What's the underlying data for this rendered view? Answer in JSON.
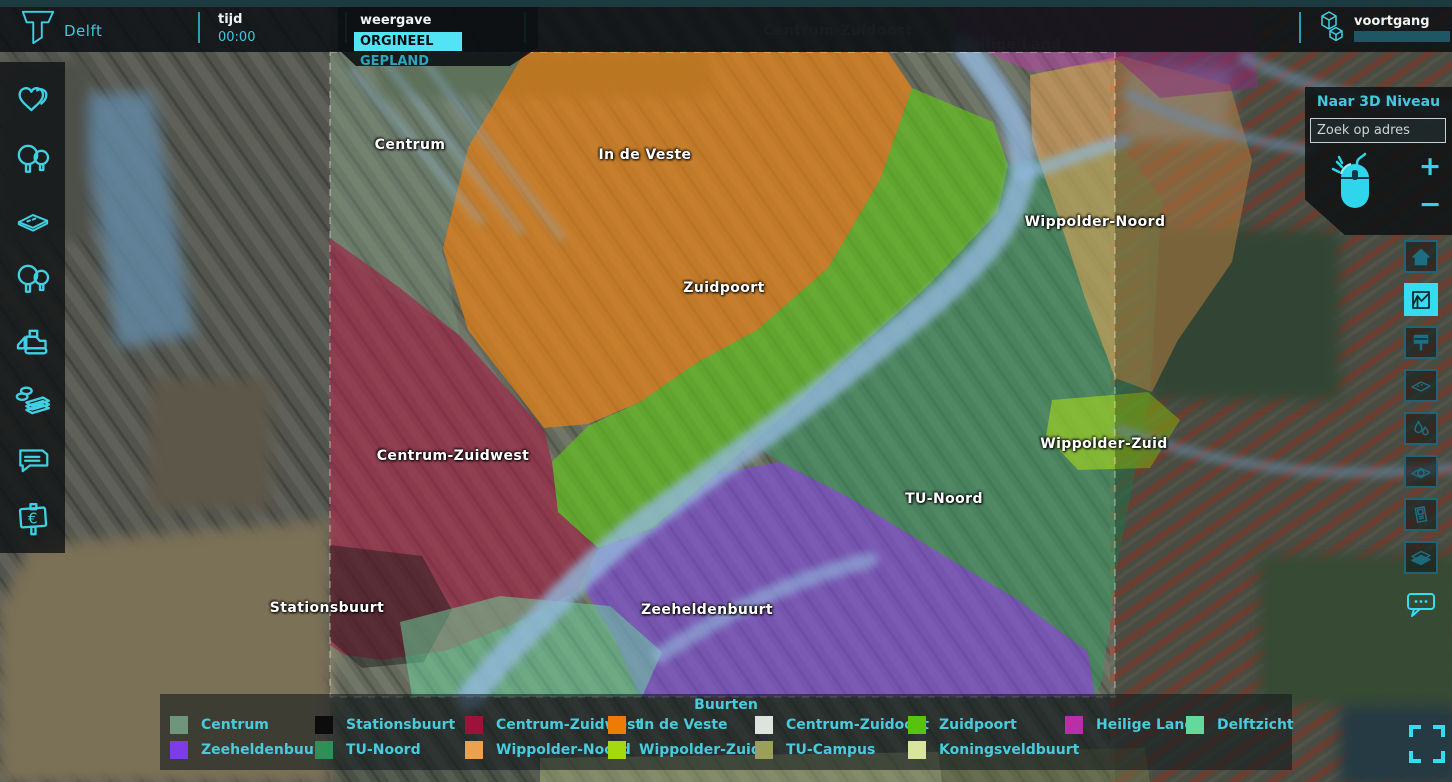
{
  "header": {
    "city": "Delft",
    "time": {
      "label": "tijd",
      "value": "00:00"
    },
    "view": {
      "label": "weergave",
      "selected": "ORGINEEL",
      "alternative": "GEPLAND"
    },
    "progress": {
      "label": "voortgang"
    }
  },
  "left_toolbar": {
    "items": [
      {
        "icon": "hearts-icon"
      },
      {
        "icon": "trees-icon"
      },
      {
        "icon": "surface-tile-icon"
      },
      {
        "icon": "trees-icon"
      },
      {
        "icon": "bulldozer-icon"
      },
      {
        "icon": "money-icon"
      },
      {
        "icon": "chat-icon"
      },
      {
        "icon": "euro-board-icon"
      }
    ]
  },
  "right_panel": {
    "to_3d_label": "Naar 3D Niveau",
    "search_placeholder": "Zoek op adres",
    "zoom_in": "+",
    "zoom_out": "−"
  },
  "right_toolbar": {
    "items": [
      {
        "icon": "home-icon",
        "active": false
      },
      {
        "icon": "chart-icon",
        "active": true
      },
      {
        "icon": "billboard-icon",
        "active": false
      },
      {
        "icon": "flat-layer-icon",
        "active": false
      },
      {
        "icon": "water-drop-icon",
        "active": false
      },
      {
        "icon": "zone-circle-icon",
        "active": false
      },
      {
        "icon": "panel-card-icon",
        "active": false
      },
      {
        "icon": "layers-stack-icon",
        "active": false
      },
      {
        "icon": "chat-dots-icon",
        "active": false
      }
    ]
  },
  "map": {
    "labels": [
      {
        "text": "Centrum"
      },
      {
        "text": "In de Veste"
      },
      {
        "text": "Zuidpoort"
      },
      {
        "text": "Wippolder-Noord"
      },
      {
        "text": "Centrum-Zuidwest"
      },
      {
        "text": "Wippolder-Zuid"
      },
      {
        "text": "TU-Noord"
      },
      {
        "text": "Stationsbuurt"
      },
      {
        "text": "Zeeheldenbuurt"
      },
      {
        "text": "Centrum-Zuidoost"
      },
      {
        "text": "Heilige Land"
      }
    ]
  },
  "legend": {
    "title": "Buurten",
    "items": [
      {
        "label": "Centrum",
        "color": "#6f967a"
      },
      {
        "label": "Stationsbuurt",
        "color": "#0c0c0c"
      },
      {
        "label": "Centrum-Zuidwest",
        "color": "#9c1238"
      },
      {
        "label": "In de Veste",
        "color": "#ee7c04"
      },
      {
        "label": "Centrum-Zuidoost",
        "color": "#dde4dd"
      },
      {
        "label": "Zuidpoort",
        "color": "#58c20e"
      },
      {
        "label": "Heilige Land",
        "color": "#b92fa5"
      },
      {
        "label": "Delftzicht",
        "color": "#63d99c"
      },
      {
        "label": "Zeeheldenbuurt",
        "color": "#7c3de6"
      },
      {
        "label": "TU-Noord",
        "color": "#2e8f58"
      },
      {
        "label": "Wippolder-Noord",
        "color": "#eba24e"
      },
      {
        "label": "Wippolder-Zuid",
        "color": "#a4d90f"
      },
      {
        "label": "TU-Campus",
        "color": "#9aa05c"
      },
      {
        "label": "Koningsveldbuurt",
        "color": "#d9e59c"
      }
    ]
  },
  "colors": {
    "accent": "#3fd0e4",
    "accent_bright": "#52e4f4",
    "water": "#8db4dc"
  }
}
